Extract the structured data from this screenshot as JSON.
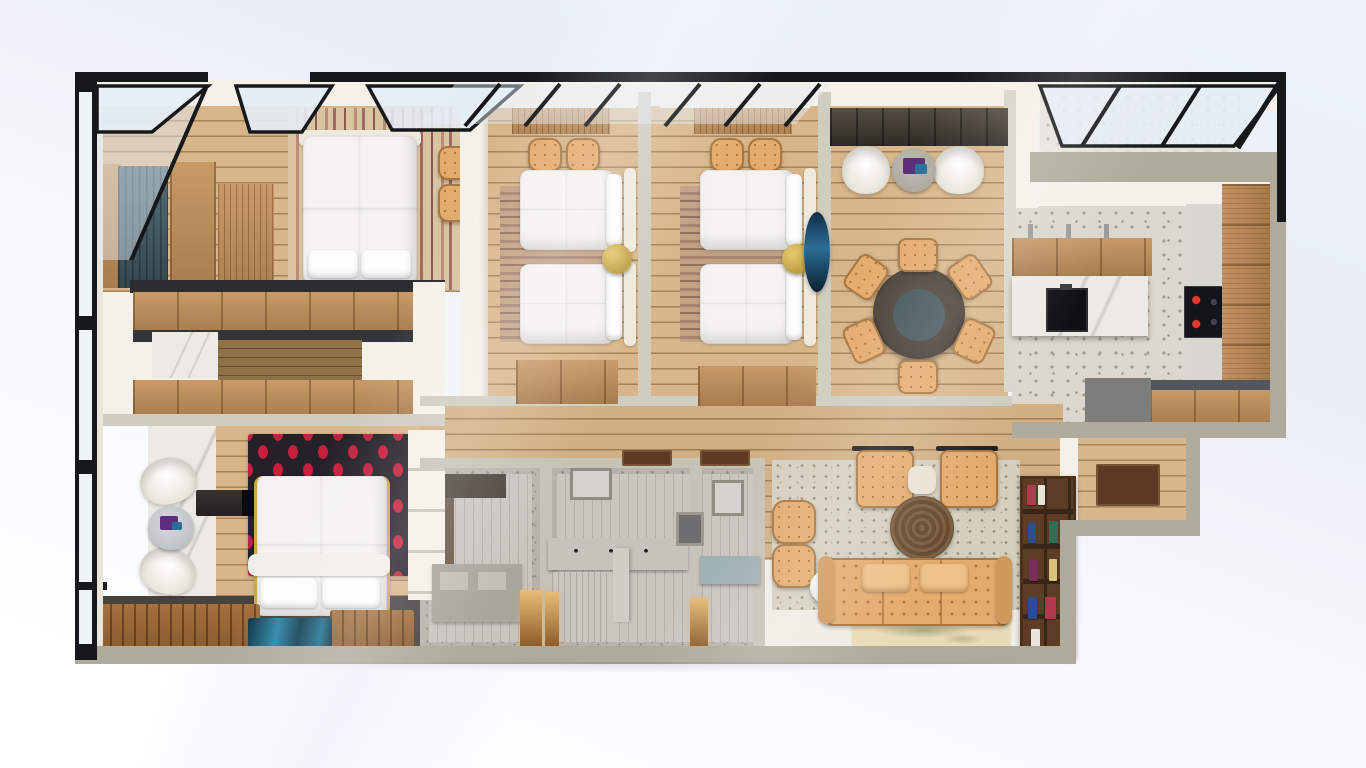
{
  "scene": {
    "title": "3D apartment floor plan render",
    "view": "top-down dollhouse perspective"
  },
  "palette": {
    "wall_outer": "#aeab9c",
    "wall_inner": "#cfccc0",
    "wall_white": "#f4f1e9",
    "frame_black": "#17181b",
    "glass": "#e4edf6",
    "wood_floor": "#d8b68a",
    "wood_cabinet": "#b9895c",
    "wood_walkway": "#8f7148",
    "counter_dark": "#2c2e31",
    "teal_cabinet": "#4d626b",
    "bed_white": "#f4f3f1",
    "gold": "#c9a84c",
    "rug_red_base": "#262129",
    "rug_red_petal": "#c41f3e",
    "rug_blue": "#1d6f8e",
    "tan": "#e3ab6e",
    "tan_dark": "#a8763f",
    "cream": "#f1efe9",
    "table_rim": "#463d35",
    "table_top": "#44565b",
    "terrazzo": "#dbd7ce",
    "terrazzo_dot": "#a39d8e",
    "bath_wall": "#b7b3ab",
    "bath_floor": "#c9c6c0",
    "tile_dark": "#6b5748",
    "jute": "#6f5539",
    "map_rug": "#e8dbb7",
    "shelf_wood": "#5d3d26",
    "marble": "#eceae4",
    "floor_dark": "#46433f",
    "mat_brown": "#5d3b22",
    "book1": "#b23a4e",
    "book2": "#2f6e4f",
    "book3": "#2b4f8a",
    "book4": "#e8e4da",
    "book5": "#7a2d5a",
    "book6": "#d9c27a"
  },
  "rooms": [
    {
      "id": "bedroom-1",
      "label": "Bedroom 1",
      "furniture": [
        "double bed",
        "striped rug",
        "wardrobes",
        "teal cabinet",
        "two stools"
      ]
    },
    {
      "id": "walk-in-closet",
      "label": "Walk-in Closet",
      "furniture": [
        "upper wardrobe row",
        "lower wardrobe row",
        "marble tile",
        "wood walkway"
      ]
    },
    {
      "id": "master-bedroom",
      "label": "Master Bedroom",
      "furniture": [
        "double bed",
        "petal rug",
        "two armchairs",
        "round side table",
        "media console",
        "blue rug",
        "slat benches"
      ]
    },
    {
      "id": "twin-bedroom-a",
      "label": "Twin Bedroom A",
      "furniture": [
        "two single beds",
        "gold nightstand",
        "striped rug",
        "desk",
        "two stools",
        "wardrobe"
      ]
    },
    {
      "id": "twin-bedroom-b",
      "label": "Twin Bedroom B",
      "furniture": [
        "two single beds",
        "gold nightstand",
        "striped rug",
        "desk",
        "two stools",
        "wardrobe",
        "hanging chair"
      ]
    },
    {
      "id": "lounge-dining",
      "label": "Lounge & Dining",
      "furniture": [
        "round dining table",
        "six dining chairs",
        "two armchairs",
        "round side table",
        "dark console"
      ]
    },
    {
      "id": "kitchen",
      "label": "Kitchen",
      "furniture": [
        "island with coffee machine",
        "induction cooktop",
        "tall cabinets",
        "counters"
      ]
    },
    {
      "id": "terrace",
      "label": "Terrace",
      "furniture": [
        "glass roof"
      ]
    },
    {
      "id": "hallway",
      "label": "Hallway",
      "furniture": [
        "door mats"
      ]
    },
    {
      "id": "bathroom-1",
      "label": "Bathroom 1",
      "furniture": [
        "vanity",
        "dark tiled shower"
      ]
    },
    {
      "id": "bathroom-2",
      "label": "Bathroom 2",
      "furniture": [
        "double vanity",
        "shower",
        "window"
      ]
    },
    {
      "id": "bathroom-3",
      "label": "Bathroom 3",
      "furniture": [
        "vanity",
        "window"
      ]
    },
    {
      "id": "living-room",
      "label": "Living Room",
      "furniture": [
        "tufted sofa",
        "two lounge chairs",
        "ottomans",
        "jute rug",
        "bookshelf",
        "map rug",
        "side table"
      ]
    },
    {
      "id": "entry",
      "label": "Entry",
      "furniture": [
        "door mat"
      ]
    }
  ]
}
